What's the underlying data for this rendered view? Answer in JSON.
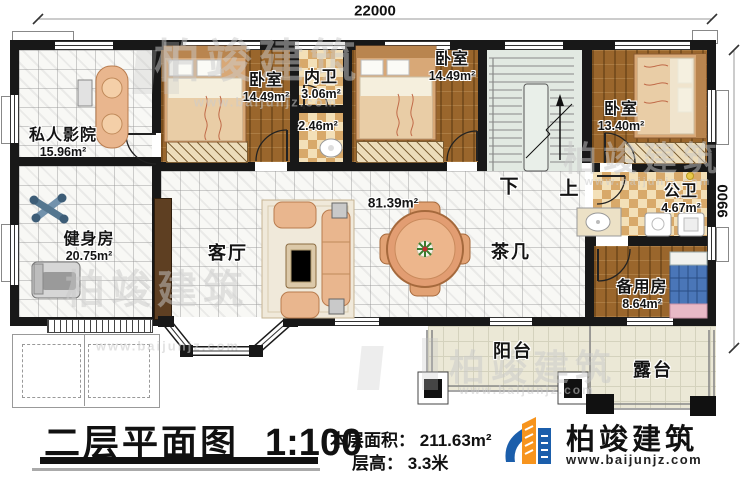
{
  "dimensions": {
    "width_label": "22000",
    "height_label": "9900"
  },
  "rooms": {
    "cinema": {
      "label": "私人影院",
      "area": "15.96m²"
    },
    "bedroom1": {
      "label": "卧室",
      "area": "14.49m²"
    },
    "inner_bath": {
      "label": "内卫",
      "area": "3.06m²"
    },
    "closet": {
      "area": "2.46m²"
    },
    "bedroom2": {
      "label": "卧室",
      "area": "14.49m²"
    },
    "bedroom3": {
      "label": "卧室",
      "area": "13.40m²"
    },
    "public_bath": {
      "label": "公卫",
      "area": "4.67m²"
    },
    "gym": {
      "label": "健身房",
      "area": "20.75m²"
    },
    "living": {
      "label": "客厅",
      "area": "81.39m²"
    },
    "tea_table": {
      "label": "茶几"
    },
    "spare_room": {
      "label": "备用房",
      "area": "8.64m²"
    },
    "balcony": {
      "label": "阳台"
    },
    "terrace": {
      "label": "露台"
    }
  },
  "stairs": {
    "down": "下",
    "up": "上"
  },
  "titleblock": {
    "title": "二层平面图",
    "scale": "1:100",
    "area_label": "本层面积：",
    "area_value": "211.63m²",
    "floor_height_label": "层高：",
    "floor_height_value": "3.3米"
  },
  "brand": {
    "name": "柏竣建筑",
    "website": "www.baijunjz.com"
  },
  "watermark": {
    "text": "柏竣建筑",
    "url": "www.baijunjz.com"
  },
  "colors": {
    "wall": "#181818",
    "wood_floor": "#9a662c",
    "tile_floor": "#f8f8f5",
    "checker_tan": "#d8a96a",
    "deck": "#ebe8d6",
    "stair": "#e2e9e2",
    "brand_blue": "#1b5eab",
    "brand_orange": "#f7941d"
  }
}
